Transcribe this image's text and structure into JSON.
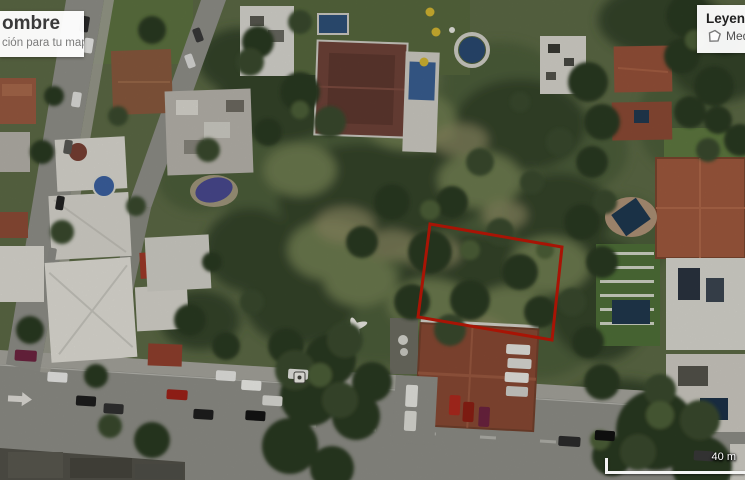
{
  "title_card": {
    "title_fragment": "ombre",
    "description_fragment": "ción para tu mapa."
  },
  "legend": {
    "title": "Leyenda",
    "items": [
      {
        "icon": "polygon-icon",
        "label_fragment": "Medic"
      }
    ]
  },
  "scale_bar": {
    "label": "40 m"
  },
  "measurement": {
    "type": "polygon",
    "points": "430,224 562,247 552,340 418,317",
    "stroke_color": "#a81405",
    "fill": "none"
  },
  "map": {
    "view": "satellite"
  },
  "colors": {
    "measure_red": "#a81405",
    "card_background": "#ffffff",
    "road_gray": "#8f8f88",
    "vegetation_green": "#4e5f3a"
  }
}
